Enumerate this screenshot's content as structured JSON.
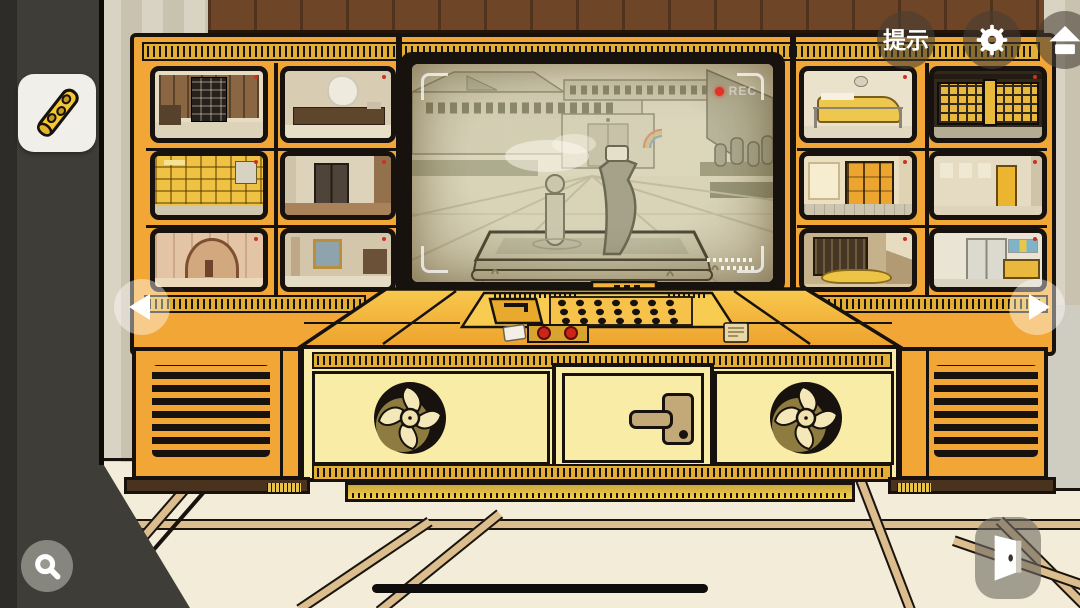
{
  "header": {
    "hint_label": "提示"
  },
  "big_screen": {
    "rec_label": "REC",
    "scene": "courtyard-fountain-hand-statue-camera"
  },
  "monitor_wall": {
    "left_screens": [
      "study-shelves-cabinet",
      "office-desk-doodle",
      "yellow-bookshelf",
      "elevator-hall",
      "arch-corridor",
      "gallery-paintings"
    ],
    "right_screens": [
      "reception-counter-barrier",
      "shoe-locker-wall",
      "yellow-lockers-room",
      "poster-hallway-yellow-door",
      "tatami-entrance",
      "elevator-vending-hall"
    ]
  },
  "inventory": {
    "items": [
      {
        "name": "notched-yellow-rod"
      }
    ]
  },
  "icons": {
    "settings": "gear-icon",
    "home": "home-icon",
    "search": "magnifier-icon",
    "exit": "door-icon",
    "nav_left": "left-arrow-icon",
    "nav_right": "right-arrow-icon"
  },
  "colors": {
    "cabinet_orange": "#f1a636",
    "desk_cream": "#f8eca6",
    "rec_red": "#e03226",
    "overlay_button": "rgba(70,62,52,0.58)",
    "floor": "#f2ecd8"
  }
}
